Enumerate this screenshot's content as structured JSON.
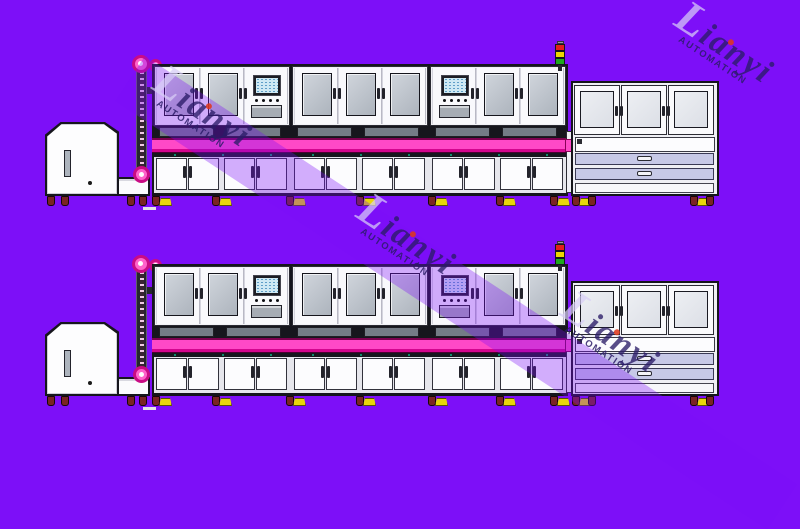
{
  "watermark": {
    "brand": "Lianyi",
    "subtitle": "AUTOMATION"
  },
  "colors": {
    "background": "#7D0FF8",
    "stripe_overlay": "rgba(124,12,248,0.33)",
    "watermark_text": "#2B1C68",
    "pink_conveyor": "#FF49C7",
    "pink_conveyor_dark": "#D4058E",
    "window_glass": "#ADB4BD",
    "work_surface": "#747C86",
    "hmi_screen": "#CFE9F4",
    "drawer_lavender": "#C7C9E7",
    "foot_yellow": "#E8D60A",
    "caster_wheel": "#7A2424",
    "sprocket_ring": "#C90C84",
    "sprocket_fill": "#FF63CC",
    "tower_red": "#E31E1E",
    "tower_yellow": "#EDD500",
    "tower_green": "#1FA91F"
  },
  "scene": {
    "rows": [
      {
        "name": "production-line-row-1",
        "top": 0
      },
      {
        "name": "production-line-row-2",
        "top": 200
      }
    ],
    "feeder": {
      "name": "feeder-machine"
    },
    "elevator": {
      "name": "chain-elevator",
      "sprockets": 3
    },
    "main_line": {
      "modules": [
        {
          "name": "process-module-1",
          "cabinets": [
            "window",
            "window",
            "hmi"
          ]
        },
        {
          "name": "process-module-2",
          "cabinets": [
            "window",
            "window",
            "window"
          ]
        },
        {
          "name": "process-module-3",
          "cabinets": [
            "hmi",
            "window",
            "window"
          ]
        }
      ],
      "lower_doors_per_module": 4
    },
    "signal_tower": {
      "lights": [
        "red",
        "yellow",
        "green"
      ]
    },
    "right_machine": {
      "windows": 3,
      "drawers": 2
    }
  }
}
